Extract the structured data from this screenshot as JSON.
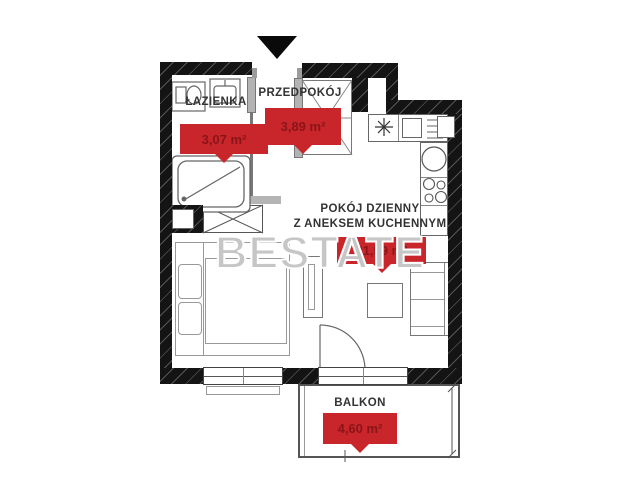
{
  "watermark": {
    "text": "BESTATE"
  },
  "rooms": [
    {
      "label": "ŁAZIENKA",
      "area": "3,07 m²"
    },
    {
      "label": "PRZEDPOKÓJ",
      "area": "3,89 m²"
    },
    {
      "label": "POKÓJ DZIENNY",
      "label2": "Z ANEKSEM KUCHENNYM",
      "area": "21,59 m²"
    },
    {
      "label": "BALKON",
      "area": "4,60 m²"
    }
  ],
  "colors": {
    "badge_background": "#c9262b",
    "badge_text": "#8a1418",
    "wall": "#141414",
    "watermark_gray": "#c6c6c6"
  }
}
